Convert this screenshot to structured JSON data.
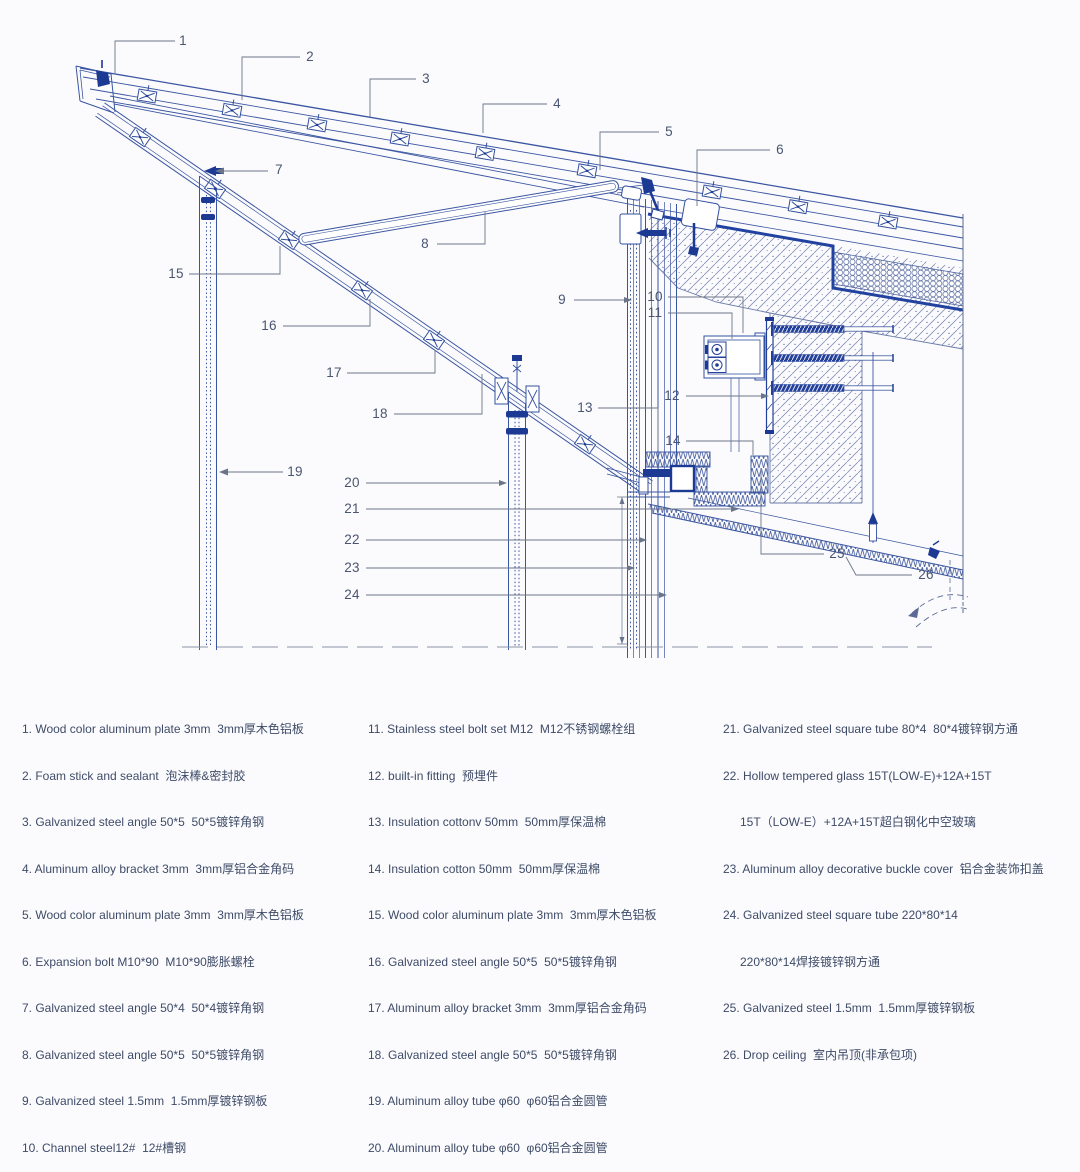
{
  "callouts": [
    "1",
    "2",
    "3",
    "4",
    "5",
    "6",
    "7",
    "8",
    "9",
    "10",
    "11",
    "12",
    "13",
    "14",
    "15",
    "16",
    "17",
    "18",
    "19",
    "20",
    "21",
    "22",
    "23",
    "24",
    "25",
    "26"
  ],
  "legend": {
    "col1": [
      "1. Wood color aluminum plate 3mm  3mm厚木色铝板",
      "2. Foam stick and sealant  泡沫棒&密封胶",
      "3. Galvanized steel angle 50*5  50*5镀锌角钢",
      "4. Aluminum alloy bracket 3mm  3mm厚铝合金角码",
      "5. Wood color aluminum plate 3mm  3mm厚木色铝板",
      "6. Expansion bolt M10*90  M10*90膨胀螺栓",
      "7. Galvanized steel angle 50*4  50*4镀锌角钢",
      "8. Galvanized steel angle 50*5  50*5镀锌角钢",
      "9. Galvanized steel 1.5mm  1.5mm厚镀锌钢板",
      "10. Channel steel12#  12#槽钢"
    ],
    "col2": [
      "11. Stainless steel bolt set M12  M12不锈钢螺栓组",
      "12. built-in fitting  预埋件",
      "13. Insulation cottonv 50mm  50mm厚保温棉",
      "14. Insulation cotton 50mm  50mm厚保温棉",
      "15. Wood color aluminum plate 3mm  3mm厚木色铝板",
      "16. Galvanized steel angle 50*5  50*5镀锌角钢",
      "17. Aluminum alloy bracket 3mm  3mm厚铝合金角码",
      "18. Galvanized steel angle 50*5  50*5镀锌角钢",
      "19. Aluminum alloy tube φ60  φ60铝合金圆管",
      "20. Aluminum alloy tube φ60  φ60铝合金圆管"
    ],
    "col3": [
      "21. Galvanized steel square tube 80*4  80*4镀锌钢方通",
      "22. Hollow tempered glass 15T(LOW-E)+12A+15T",
      "15T（LOW-E）+12A+15T超白钢化中空玻璃",
      "23. Aluminum alloy decorative buckle cover  铝合金装饰扣盖",
      "24. Galvanized steel square tube 220*80*14",
      "220*80*14焊接镀锌钢方通",
      "25. Galvanized steel 1.5mm  1.5mm厚镀锌钢板",
      "26. Drop ceiling  室内吊顶(非承包项)"
    ]
  },
  "colors": {
    "line_blue": "#3a55a1",
    "deep_navy": "#1c3a94",
    "thick_membrane": "#2242a0",
    "leader_gray": "#6b7588",
    "text": "#3e4b68"
  }
}
